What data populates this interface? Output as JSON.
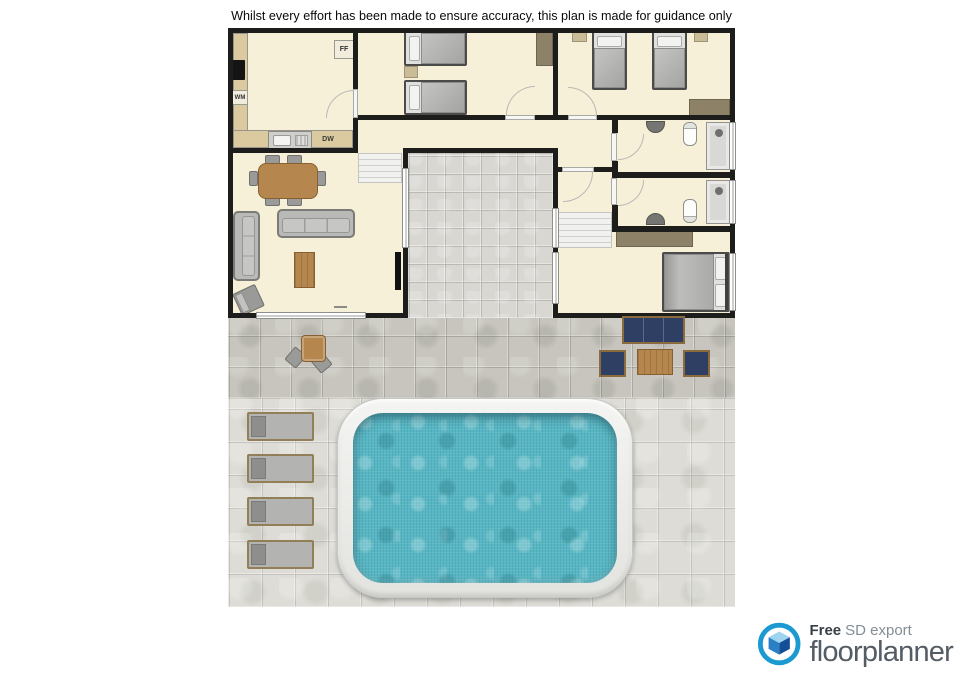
{
  "disclaimer": "Whilst every effort has been made to ensure accuracy, this plan is made for guidance only",
  "floor_plan": {
    "appliance_labels": {
      "fridge_freezer": "FF",
      "washing_machine": "WM",
      "dishwasher": "DW"
    }
  },
  "branding": {
    "free": "Free",
    "export_type": "SD export",
    "brand": "floorplanner"
  },
  "colors": {
    "wall": "#1d1d1b",
    "floor": "#f7f0d8",
    "counter": "#dbc99f",
    "courtyard": "#d8d7d2",
    "patio": "#c7c5bd",
    "deck": "#dddcd6",
    "water": "#57b6c3",
    "navy": "#2e3f63",
    "wood": "#b5874e",
    "logoblue": "#1b9ad2"
  }
}
